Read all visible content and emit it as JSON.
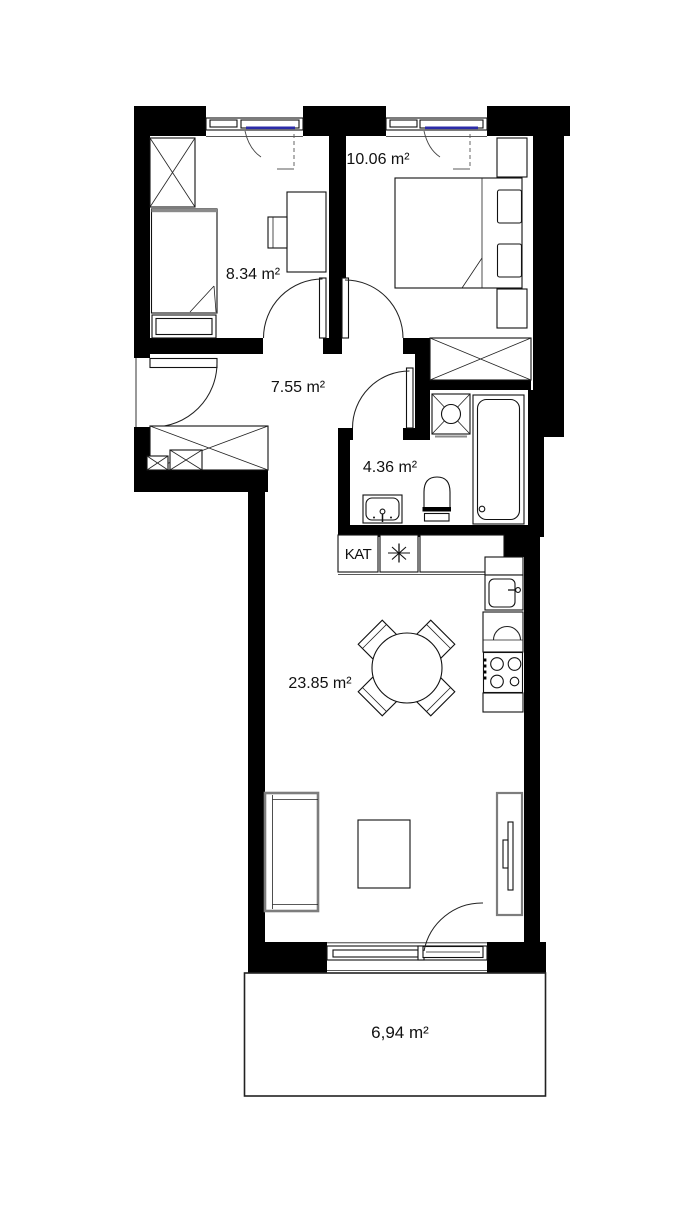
{
  "plan": {
    "type": "apartment-floor-plan",
    "colors": {
      "wall": "#000000",
      "glazing": "#2b2ba8",
      "furniture_gray": "#7d7d7d",
      "text": "#111111"
    },
    "rooms": {
      "bedroom_small": {
        "name": "small-bedroom",
        "area": "8.34 m²"
      },
      "bedroom_large": {
        "name": "large-bedroom",
        "area": "10.06 m²"
      },
      "hallway": {
        "name": "hallway",
        "area": "7.55 m²"
      },
      "bathroom": {
        "name": "bathroom",
        "area": "4.36 m²"
      },
      "living_kitchen": {
        "name": "living-room-with-kitchenette",
        "area": "23.85 m²"
      },
      "balcony": {
        "name": "balcony",
        "area": "6,94 m²"
      }
    },
    "annotations": {
      "kat_label": "KAT",
      "star_symbol": "✳"
    },
    "icons": [
      "wardrobe-icon",
      "single-bed-icon",
      "desk-icon",
      "chair-icon",
      "double-bed-icon",
      "nightstand-icon",
      "washing-machine-icon",
      "bathtub-icon",
      "toilet-icon",
      "washbasin-icon",
      "kitchen-sink-icon",
      "stove-icon",
      "dining-table-icon",
      "sofa-icon",
      "coffee-table-icon",
      "tv-icon",
      "door-swing-icon",
      "window-icon"
    ]
  }
}
